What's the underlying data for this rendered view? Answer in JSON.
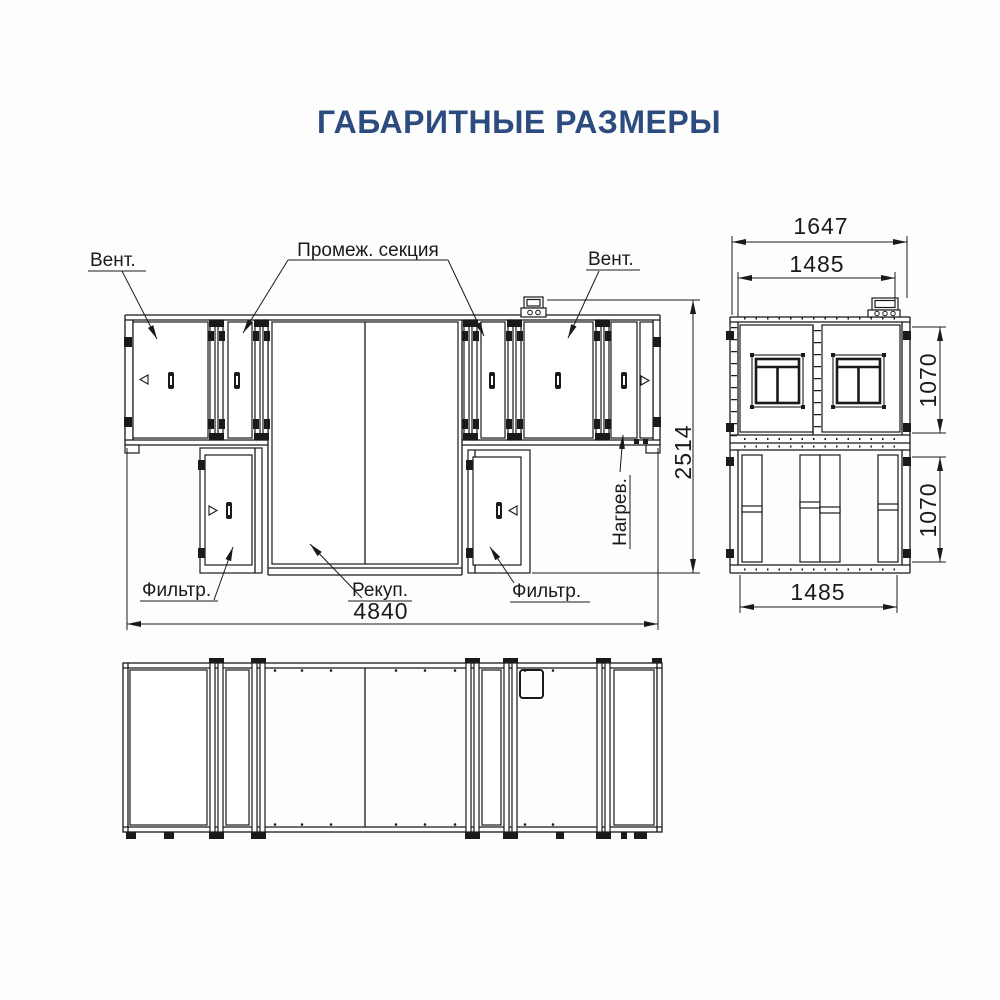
{
  "title": "ГАБАРИТНЫЕ РАЗМЕРЫ",
  "colors": {
    "title": "#2C4B7E",
    "line": "#1A1A1A",
    "background": "#FDFDFE"
  },
  "front_view": {
    "labels": {
      "fan_left": "Вент.",
      "intermediate_section": "Промеж. секция",
      "fan_right": "Вент.",
      "filter_left": "Фильтр.",
      "recuperator": "Рекуп.",
      "filter_right": "Фильтр.",
      "heater": "Нагрев."
    },
    "dimensions": {
      "overall_length": "4840",
      "overall_height": "2514"
    }
  },
  "side_view": {
    "dimensions": {
      "overall_width": "1647",
      "body_width": "1485",
      "upper_tier_height": "1070",
      "lower_tier_height": "1070",
      "lower_body_width": "1485"
    }
  }
}
